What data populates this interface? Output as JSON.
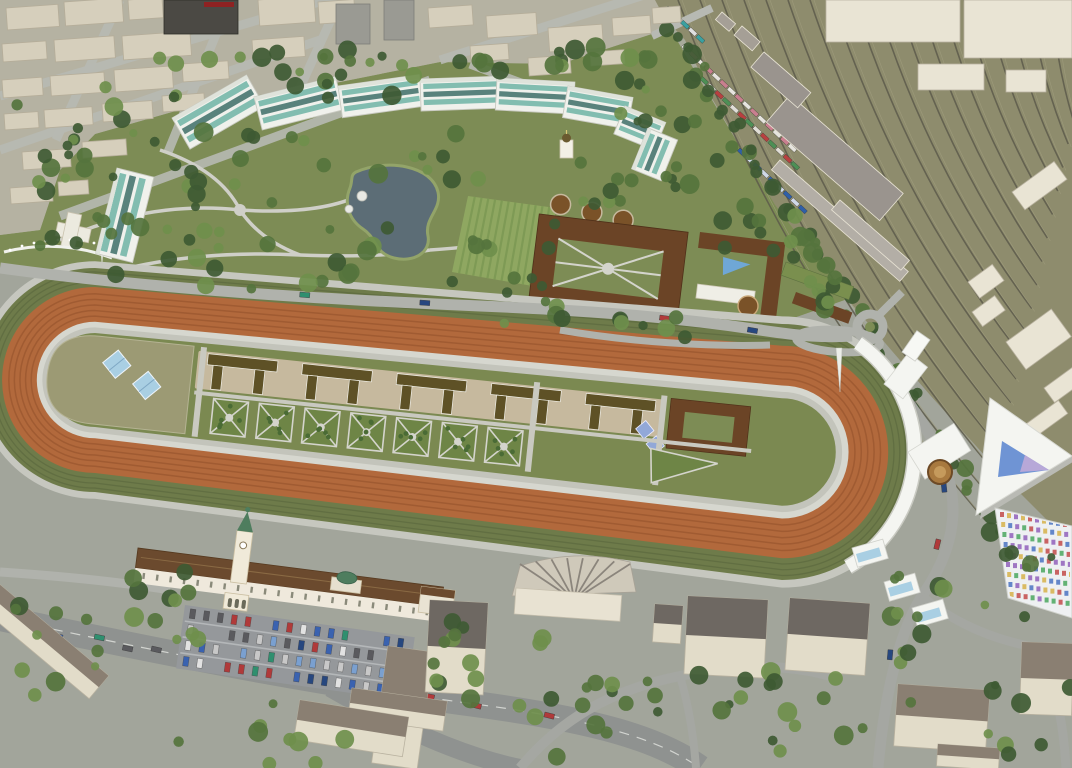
{
  "meta": {
    "title": "Aerial 3D rendering of a hippodrome redevelopment masterplan",
    "description": "Bird's-eye architectural visualization: oval racetrack with orange and green lanes, infield stable rows and garden parterres, curved white grandstand with triangular glass-roof pavilion, arc of teal-glass residential blocks around a landscaped park with a pond and chapel, stable quadrangle court, large railway yard with freight trains, historic towered grandstand with car park, city blocks and tree-lined streets"
  },
  "scene": {
    "areas": [
      {
        "name": "city-blocks-northwest",
        "desc": "beige low-rise city blocks, gray streets, dark tower with red band"
      },
      {
        "name": "residential-arc",
        "desc": "curved row of white apartment buildings with teal glass facades"
      },
      {
        "name": "central-park",
        "desc": "park with kidney-shaped pond, winding paths, striped lawns, white chapel"
      },
      {
        "name": "railway-yard",
        "desc": "fan of railway tracks on khaki ballast with freight trains and warehouses"
      },
      {
        "name": "racetrack",
        "desc": "oval course: outer olive turf lanes, orange dirt track, inner paths"
      },
      {
        "name": "infield",
        "desc": "stable rows with dark roofs, square garden parterres, khaki apron with skylights"
      },
      {
        "name": "stable-quadrangle",
        "desc": "brown-roofed courtyard stables with round pens and blue pool"
      },
      {
        "name": "east-grandstand",
        "desc": "curved white grandstand, canopy, mast, medallion plaza, triangular glass-roof hall, colorful tribune seats"
      },
      {
        "name": "historic-grandstand",
        "desc": "long white building, clock tower with green spire, arched gate, car park"
      },
      {
        "name": "south-quarter",
        "desc": "streets with traffic, beige mid-rise buildings, fan-roofed hall, trees"
      }
    ],
    "landmarks": [
      "racetrack-oval",
      "triangle-glass-pavilion",
      "clock-tower",
      "pond",
      "chapel",
      "roundabout",
      "railway-yard"
    ]
  },
  "palette": {
    "base_ground": "#a7aa9b",
    "city_ground": "#b5b2a2",
    "park_green": "#7d8c55",
    "bottom_ground": "#a2a59b",
    "rail_ground": "#8e8c6d",
    "rail_track": "#5d5a4b",
    "rail_light": "#a09d7e",
    "city_building": "#d6cfbc",
    "city_building_edge": "#b5ad99",
    "city_gray": "#9a9a93",
    "dark_tower": "#4b4944",
    "red_band": "#8e2222",
    "street": "#b7b9b3",
    "road": "#8f9290",
    "road_light": "#b0b2ac",
    "lane_dash": "#d2d4d0",
    "path": "#cfcfc8",
    "pond": "#5c6d76",
    "shore": "#93a469",
    "lawn_field": "#8fa761",
    "lawn_stripe": "#7e9a55",
    "tree_dark": "#3e5a33",
    "tree_mid": "#55743d",
    "tree_light": "#6f8f4c",
    "arc_white": "#f0f1ec",
    "teal_glass": "#6fb4a6",
    "teal_dark": "#3e6e68",
    "track_edge": "#c6c7bf",
    "verge_green": "#6e7b4a",
    "verge_line": "#5e6b40",
    "track_orange": "#b2693c",
    "track_orange_line": "#9b5730",
    "rail_ring": "#d6d7cf",
    "inner_ring": "#c3c4bb",
    "infield_green": "#7b8951",
    "khaki_apron": "#9c9a74",
    "skylight_blue": "#a9cfe3",
    "skylight_violet": "#92a8d8",
    "stable_roof": "#5e5126",
    "stable_court": "#c6b99e",
    "stable_white": "#efeee6",
    "quad_roof": "#6b4426",
    "quad_court": "#7d8c55",
    "arch_blue": "#7fa8c9",
    "pool_blue": "#6fa7d6",
    "parterre": "#6e8546",
    "parterre_path": "#d4d4cc",
    "shrub": "#4a6b35",
    "grandstand_white": "#f4f5f1",
    "grandstand_shadow": "#c9cac2",
    "tri_glass_blue": "#6f94d4",
    "tri_glass_violet": "#b7a8d8",
    "medallion": "#a8793f",
    "medallion_inner": "#c59a5c",
    "hist_roof": "#6b4a2e",
    "hist_wall": "#efe9dc",
    "green_dome": "#4e7d5e",
    "parking": "#95989b",
    "bldg_wall": "#e2dcc9",
    "bldg_roof_dark": "#6e6862",
    "bldg_roof_brown": "#8a7f72",
    "warehouse_roof": "#9a948e",
    "warehouse_platform": "#b3aea6",
    "seat_colors": [
      "#c65b5b",
      "#5b7fc6",
      "#5bae6e",
      "#d8b75b",
      "#9a6fc0"
    ],
    "car_colors": [
      "#3a62b0",
      "#b03a3a",
      "#e2e2e2",
      "#5a5a5e",
      "#7aa0d0",
      "#2f8f6f",
      "#c8c8c8",
      "#27477f"
    ],
    "train_a": [
      "#e6e4de",
      "#c97f8f"
    ],
    "train_b": [
      "#4d8f55",
      "#e0ddd6",
      "#b84040"
    ],
    "train_c": [
      "#2f5fa8",
      "#cfd8e8"
    ],
    "train_d": [
      "#3aa0a0",
      "#e0e0e0"
    ]
  }
}
